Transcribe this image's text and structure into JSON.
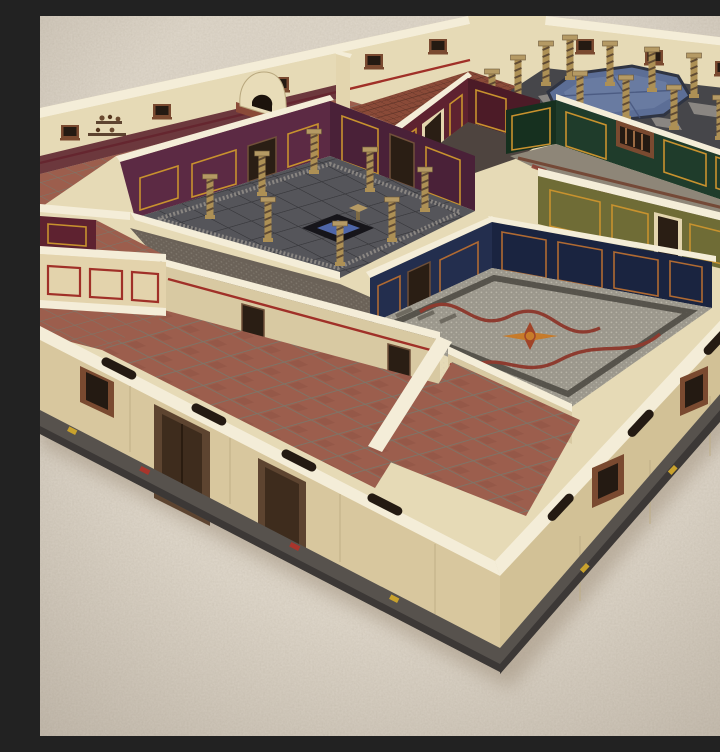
{
  "scene": {
    "type": "photograph",
    "description": "High-angle photo of a painted tabletop miniature Roman villa (domus) terrain model standing on a beige carpet, seen corner-on. Cream outer walls on a grey stone base enclose many rooms: a purple-walled atrium with spiral columns and a square impluvium, a peristyle courtyard with an octagonal blue pool, a kitchen with a domed clay oven, and rooms with dark green, olive, oxblood and navy walls trimmed in gold over terracotta, brick and mosaic floors."
  },
  "palette": {
    "carpet": "#cfc5b6",
    "carpet-light": "#ded5c7",
    "carpet-shadow": "#a2937f",
    "exterior-wall": "#e3d5ae",
    "exterior-wall-shade": "#d8c79e",
    "exterior-wall-shade2": "#d2c196",
    "wall-top": "#f4edd8",
    "plinth": "#57524d",
    "plinth-dark": "#3c3836",
    "cream-inner": "#e6dab6",
    "cream-face": "#d8c9a2",
    "red-stripe": "#a03028",
    "terracotta": "#9c5e4d",
    "terracotta-dark": "#874e40",
    "grout": "#7d7568",
    "brick": "#8a4a38",
    "dado-red": "#5e2630",
    "atrium-purple": "#5c2a44",
    "atrium-purple-shade": "#4a2138",
    "oxblood": "#5e2230",
    "oxblood-shade": "#4c1b27",
    "green-wall": "#1f3c2b",
    "green-wall-shade": "#16301f",
    "olive-wall": "#6f6c36",
    "navy-wall": "#232e4e",
    "navy-wall-shade": "#1a2440",
    "gold-trim": "#c8922e",
    "copper-trim": "#b06a32",
    "stone-floor": "#55555a",
    "stone-light": "#97928c",
    "peristyle-floor": "#46464a",
    "mosaic-base": "#9b978c",
    "mosaic-border": "#4a463f",
    "mosaic-red": "#8d3b2f",
    "mosaic-green-floor": "#8e8678",
    "star-orange": "#c77b2a",
    "star-red": "#a04428",
    "pool-blue": "#5c6e96",
    "pool-blue-light": "#7587ac",
    "pool-rim": "#2f3442",
    "column-tan": "#ad9055",
    "column-stripe": "#5f4a33",
    "capital-tan": "#b59a64",
    "door-brown": "#5d4430",
    "door-dark": "#2a1e14",
    "window-frame": "#7a4a30",
    "window-dark": "#241a12",
    "marker-yellow": "#c9a22d",
    "marker-red": "#a8352c"
  },
  "rooms": [
    {
      "id": "atrium",
      "label": "Atrium with impluvium and spiral columns",
      "walls": "purple with gold trim",
      "floor": "grey stone with mosaic border"
    },
    {
      "id": "peristyle",
      "label": "Peristyle courtyard with octagonal pool",
      "walls": "cream with windows",
      "floor": "dark flagstone with pale checker slabs"
    },
    {
      "id": "kitchen",
      "label": "Kitchen with domed clay oven and crockery shelves",
      "walls": "cream with red dado",
      "floor": "terracotta tile"
    },
    {
      "id": "brick-room",
      "label": "Back room",
      "walls": "cream with red stripe",
      "floor": "herringbone brick"
    },
    {
      "id": "red-room",
      "label": "Small oxblood room",
      "walls": "oxblood red with gold trim",
      "floor": "dark mosaic"
    },
    {
      "id": "green-room",
      "label": "Green dining room",
      "walls": "dark green with gold trim and balustrade window",
      "floor": "patterned mosaic"
    },
    {
      "id": "olive-room",
      "label": "Olive room",
      "walls": "olive green with gold trim",
      "floor": "mostly hidden"
    },
    {
      "id": "blue-room",
      "label": "Blue mosaic room",
      "walls": "navy blue with copper trim",
      "floor": "tessellated mosaic with red ribbons and orange star"
    },
    {
      "id": "tiled-hall",
      "label": "Front hall",
      "walls": "cream with red stripe",
      "floor": "terracotta tile"
    },
    {
      "id": "vestibule",
      "label": "Vestibule",
      "walls": "cream with red stripe",
      "floor": "terracotta tile"
    },
    {
      "id": "side-rooms",
      "label": "West store rooms",
      "walls": "cream with red framed panels",
      "floor": "terracotta tile"
    }
  ],
  "features": [
    "octagonal blue pool",
    "square impluvium basin with blue water",
    "8 spiral columns in the atrium",
    "12 spiral columns around the peristyle",
    "domed clay oven on brick base",
    "wall shelves with pottery",
    "open window slots cut through wall tops",
    "wooden exterior doors and window frames",
    "grey stone foundation with small red and yellow markers",
    "textured beige carpet background"
  ]
}
